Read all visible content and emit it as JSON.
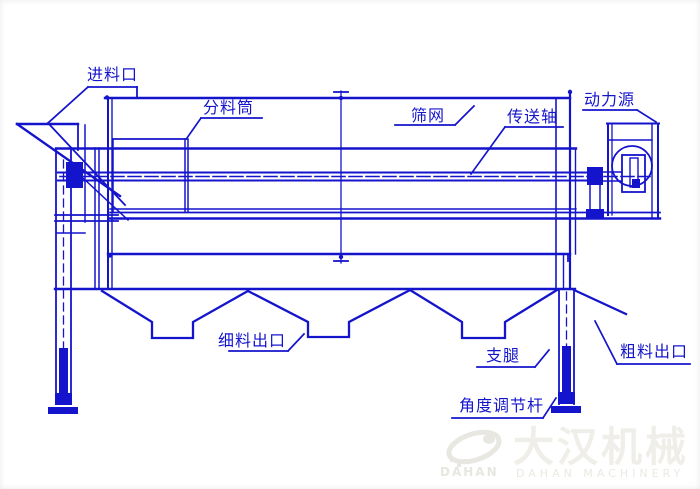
{
  "labels": {
    "feed_inlet": "进料口",
    "distribution_cylinder": "分料筒",
    "screen_mesh": "筛网",
    "transmission_shaft": "传送轴",
    "power_source": "动力源",
    "fine_material_outlet": "细料出口",
    "support_leg": "支腿",
    "coarse_material_outlet": "粗料出口",
    "angle_adjustment_rod": "角度调节杆"
  },
  "watermark": {
    "cn": "大汉机械",
    "en": "DAHAN MACHINERY",
    "logo_text": "DAHAN"
  },
  "colors": {
    "line": "#1414cd",
    "background": "#ffffff",
    "watermark": "#efeee8"
  }
}
